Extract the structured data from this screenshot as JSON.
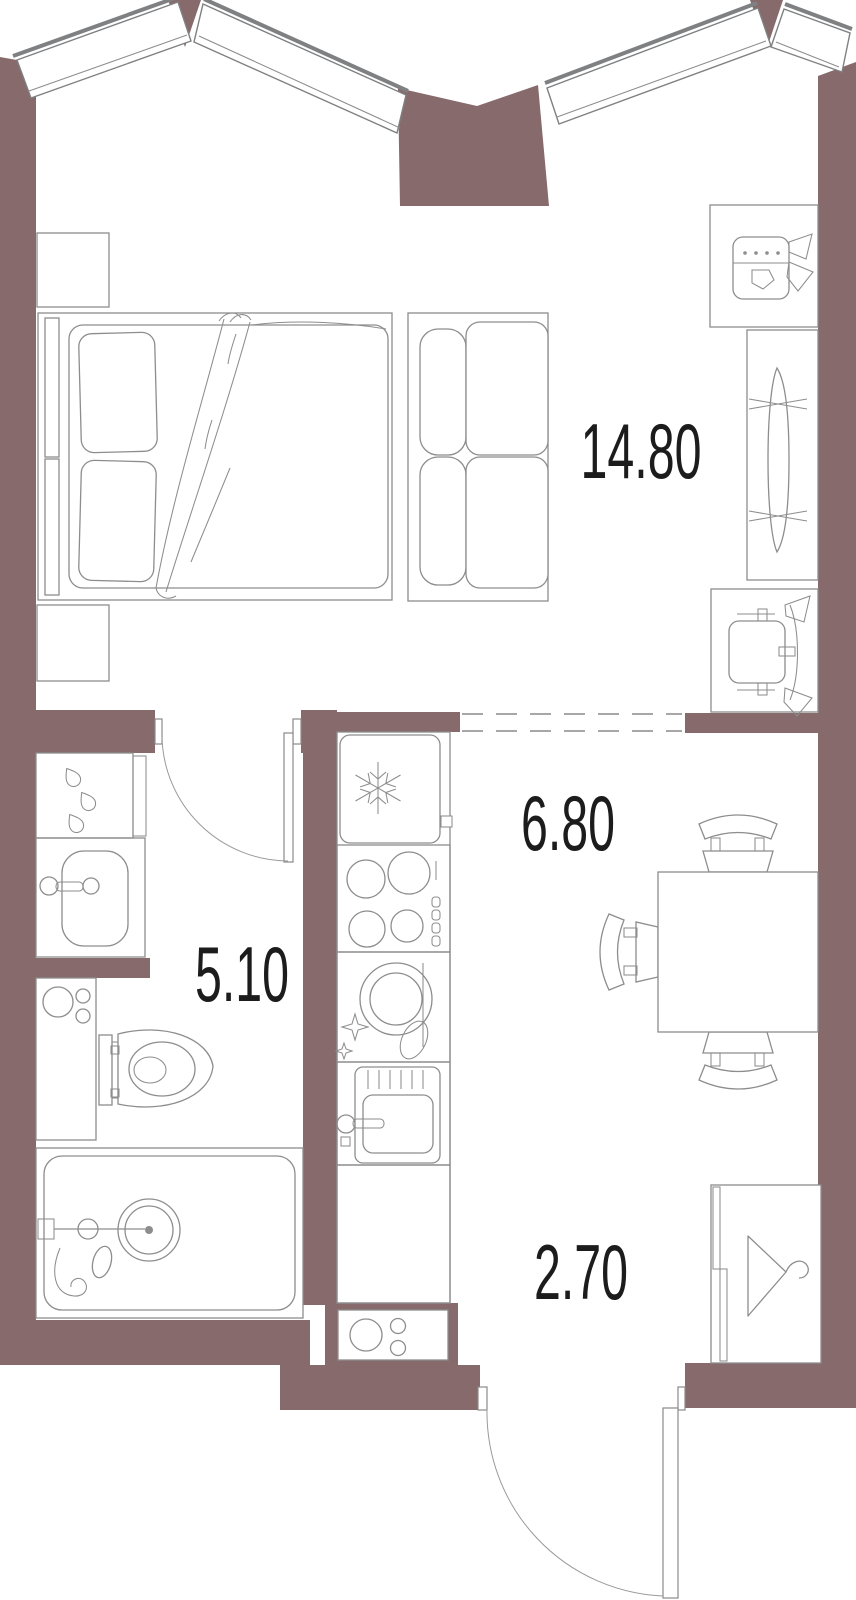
{
  "floor_plan": {
    "rooms": [
      {
        "name": "living-room",
        "area": "14.80"
      },
      {
        "name": "kitchen",
        "area": "6.80"
      },
      {
        "name": "bathroom",
        "area": "5.10"
      },
      {
        "name": "hallway",
        "area": "2.70"
      }
    ],
    "colors": {
      "wall": "#876a6b",
      "furniture_line": "#8d8d8d",
      "window_line": "#7f8082",
      "label": "#1c1c1c",
      "background": "#ffffff"
    },
    "icons": [
      "double-bed-icon",
      "pillow-icon",
      "blanket-icon",
      "nightstand-icon",
      "sofa-icon",
      "desk-chair-icon",
      "tv-stand-icon",
      "armchair-icon",
      "fridge-snowflake-icon",
      "stove-burners-icon",
      "dishwasher-icon",
      "kitchen-sink-icon",
      "dining-table-icon",
      "chair-icon",
      "towel-dryer-drops-icon",
      "washbasin-icon",
      "washing-machine-icon",
      "toilet-icon",
      "bathtub-shower-icon",
      "wardrobe-hanger-icon",
      "utility-panel-icon",
      "door-swing-icon",
      "window-band-icon",
      "dashed-opening-icon"
    ]
  }
}
